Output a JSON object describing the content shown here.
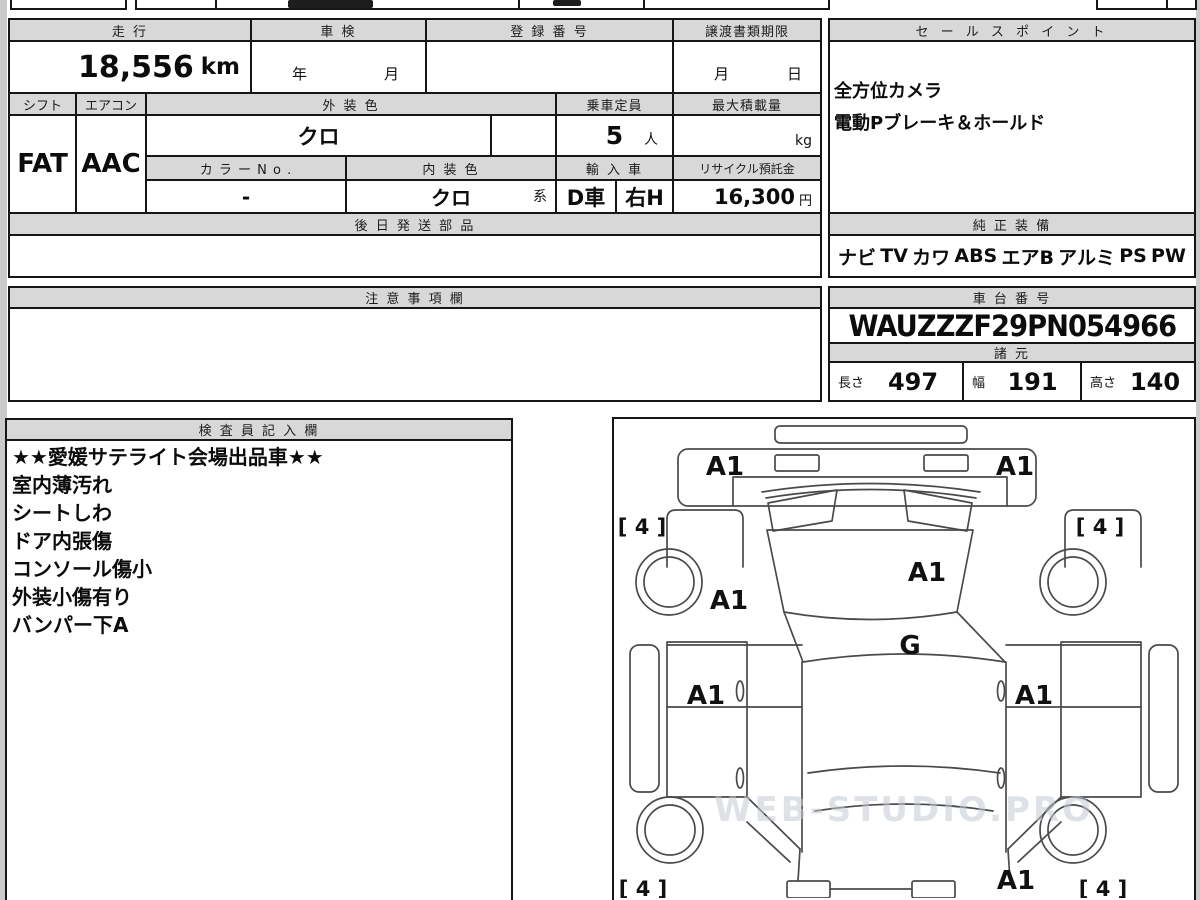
{
  "vehicle_table": {
    "h_mileage": "走 行",
    "h_inspection": "車 検",
    "h_registration": "登 録 番 号",
    "h_transfer": "譲渡書類期限",
    "mileage_value": "18,556",
    "mileage_unit": "km",
    "inspection_year": "年",
    "inspection_month": "月",
    "transfer_month": "月",
    "transfer_day": "日",
    "h_shift": "シフト",
    "h_aircon": "エアコン",
    "h_ext_color": "外 装 色",
    "h_capacity": "乗車定員",
    "h_max_load": "最大積載量",
    "shift_value": "FAT",
    "aircon_value": "AAC",
    "ext_color_value": "クロ",
    "capacity_value": "5",
    "capacity_unit": "人",
    "max_load_unit": "kg",
    "h_color_no": "カ ラ ー N o .",
    "h_int_color": "内 装 色",
    "h_import": "輸 入 車",
    "h_recycle": "リサイクル預託金",
    "color_no_value": "-",
    "int_color_value": "クロ",
    "int_color_suffix": "系",
    "import_domestic": "D車",
    "import_handle": "右H",
    "recycle_value": "16,300",
    "recycle_unit": "円",
    "h_later_parts": "後 日 発 送 部 品"
  },
  "sales_points": {
    "header": "セ ー ル ス ポ イ ン ト",
    "lines": [
      "全方位カメラ",
      "電動Pブレーキ＆ホールド"
    ]
  },
  "equipment": {
    "header": "純 正 装 備",
    "items": [
      "ナビ",
      "TV",
      "カワ",
      "ABS",
      "エアB",
      "アルミ",
      "PS",
      "PW"
    ]
  },
  "notes": {
    "header": "注 意 事 項 欄",
    "content": ""
  },
  "chassis": {
    "header": "車 台 番 号",
    "value": "WAUZZZF29PN054966"
  },
  "specs": {
    "header": "諸 元",
    "length_label": "長さ",
    "length_value": "497",
    "width_label": "幅",
    "width_value": "191",
    "height_label": "高さ",
    "height_value": "140"
  },
  "inspector": {
    "header": "検 査 員 記 入 欄",
    "lines": [
      "★★愛媛サテライト会場出品車★★",
      "室内薄汚れ",
      "シートしわ",
      "ドア内張傷",
      "コンソール傷小",
      "外装小傷有り",
      "バンパー下A"
    ]
  },
  "diagram": {
    "marks": {
      "front_bumper_left": "A1",
      "front_bumper_right": "A1",
      "tire_front_left": "[ 4 ]",
      "tire_front_right": "[ 4 ]",
      "hood_left": "A1",
      "hood_right": "A1",
      "cowl": "G",
      "door_left": "A1",
      "door_right": "A1",
      "rear_right": "A1",
      "tire_rear_left": "[ 4 ]",
      "tire_rear_right": "[ 4 ]"
    },
    "watermark": "WEB-STUDIO.PRO"
  }
}
